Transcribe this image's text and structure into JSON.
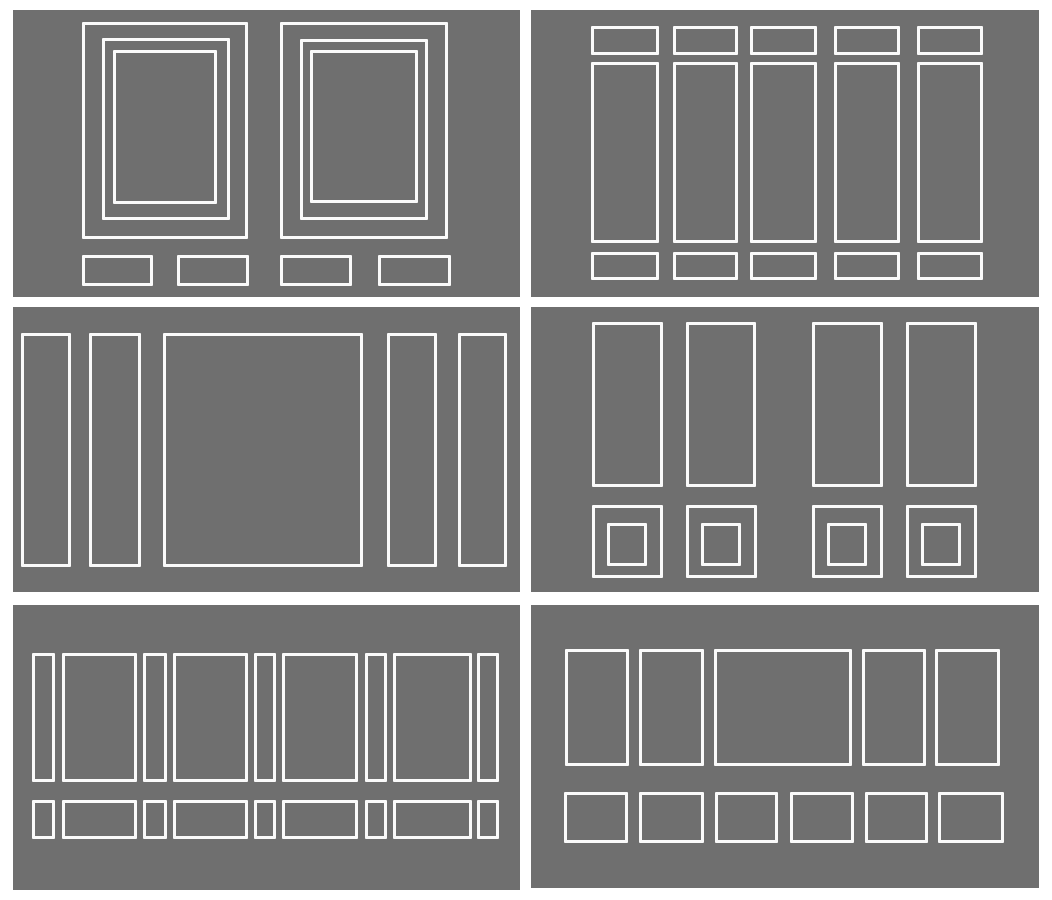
{
  "canvas": {
    "width": 1052,
    "height": 900,
    "background_color": "#ffffff"
  },
  "style": {
    "panel_background": "#6f6f6f",
    "stroke_color": "#fafafa",
    "stroke_width_px": 3
  },
  "panels": [
    {
      "key": "top-left",
      "x": 13,
      "y": 10,
      "w": 507,
      "h": 287,
      "rects": [
        {
          "x": 69,
          "y": 12,
          "w": 166,
          "h": 217
        },
        {
          "x": 89,
          "y": 28,
          "w": 128,
          "h": 182
        },
        {
          "x": 100,
          "y": 40,
          "w": 104,
          "h": 154
        },
        {
          "x": 267,
          "y": 12,
          "w": 168,
          "h": 217
        },
        {
          "x": 287,
          "y": 29,
          "w": 128,
          "h": 181
        },
        {
          "x": 297,
          "y": 40,
          "w": 108,
          "h": 153
        },
        {
          "x": 69,
          "y": 245,
          "w": 71,
          "h": 31
        },
        {
          "x": 164,
          "y": 245,
          "w": 72,
          "h": 31
        },
        {
          "x": 267,
          "y": 245,
          "w": 72,
          "h": 31
        },
        {
          "x": 365,
          "y": 245,
          "w": 73,
          "h": 31
        }
      ]
    },
    {
      "key": "top-right",
      "x": 531,
      "y": 10,
      "w": 508,
      "h": 287,
      "rects": [
        {
          "x": 60,
          "y": 16,
          "w": 68,
          "h": 29
        },
        {
          "x": 142,
          "y": 16,
          "w": 65,
          "h": 29
        },
        {
          "x": 219,
          "y": 16,
          "w": 67,
          "h": 29
        },
        {
          "x": 303,
          "y": 16,
          "w": 66,
          "h": 29
        },
        {
          "x": 386,
          "y": 16,
          "w": 66,
          "h": 29
        },
        {
          "x": 60,
          "y": 52,
          "w": 68,
          "h": 181
        },
        {
          "x": 142,
          "y": 52,
          "w": 65,
          "h": 181
        },
        {
          "x": 219,
          "y": 52,
          "w": 67,
          "h": 181
        },
        {
          "x": 303,
          "y": 52,
          "w": 66,
          "h": 181
        },
        {
          "x": 386,
          "y": 52,
          "w": 66,
          "h": 181
        },
        {
          "x": 60,
          "y": 242,
          "w": 68,
          "h": 28
        },
        {
          "x": 142,
          "y": 242,
          "w": 65,
          "h": 28
        },
        {
          "x": 219,
          "y": 242,
          "w": 67,
          "h": 28
        },
        {
          "x": 303,
          "y": 242,
          "w": 66,
          "h": 28
        },
        {
          "x": 386,
          "y": 242,
          "w": 66,
          "h": 28
        }
      ]
    },
    {
      "key": "middle-left",
      "x": 13,
      "y": 307,
      "w": 507,
      "h": 285,
      "rects": [
        {
          "x": 8,
          "y": 26,
          "w": 50,
          "h": 234
        },
        {
          "x": 76,
          "y": 26,
          "w": 52,
          "h": 234
        },
        {
          "x": 150,
          "y": 26,
          "w": 200,
          "h": 234
        },
        {
          "x": 374,
          "y": 26,
          "w": 50,
          "h": 234
        },
        {
          "x": 445,
          "y": 26,
          "w": 49,
          "h": 234
        }
      ]
    },
    {
      "key": "middle-right",
      "x": 531,
      "y": 307,
      "w": 508,
      "h": 285,
      "rects": [
        {
          "x": 61,
          "y": 15,
          "w": 71,
          "h": 165
        },
        {
          "x": 155,
          "y": 15,
          "w": 70,
          "h": 165
        },
        {
          "x": 281,
          "y": 15,
          "w": 71,
          "h": 165
        },
        {
          "x": 375,
          "y": 15,
          "w": 71,
          "h": 165
        },
        {
          "x": 61,
          "y": 198,
          "w": 71,
          "h": 73
        },
        {
          "x": 155,
          "y": 198,
          "w": 71,
          "h": 73
        },
        {
          "x": 281,
          "y": 198,
          "w": 71,
          "h": 73
        },
        {
          "x": 375,
          "y": 198,
          "w": 71,
          "h": 73
        },
        {
          "x": 76,
          "y": 216,
          "w": 40,
          "h": 43
        },
        {
          "x": 170,
          "y": 216,
          "w": 40,
          "h": 43
        },
        {
          "x": 296,
          "y": 216,
          "w": 40,
          "h": 43
        },
        {
          "x": 390,
          "y": 216,
          "w": 40,
          "h": 43
        }
      ]
    },
    {
      "key": "bottom-left",
      "x": 13,
      "y": 605,
      "w": 507,
      "h": 285,
      "rects": [
        {
          "x": 19,
          "y": 48,
          "w": 23,
          "h": 129
        },
        {
          "x": 49,
          "y": 48,
          "w": 75,
          "h": 129
        },
        {
          "x": 130,
          "y": 48,
          "w": 24,
          "h": 129
        },
        {
          "x": 160,
          "y": 48,
          "w": 75,
          "h": 129
        },
        {
          "x": 241,
          "y": 48,
          "w": 22,
          "h": 129
        },
        {
          "x": 269,
          "y": 48,
          "w": 76,
          "h": 129
        },
        {
          "x": 352,
          "y": 48,
          "w": 22,
          "h": 129
        },
        {
          "x": 380,
          "y": 48,
          "w": 79,
          "h": 129
        },
        {
          "x": 464,
          "y": 48,
          "w": 22,
          "h": 129
        },
        {
          "x": 19,
          "y": 195,
          "w": 23,
          "h": 39
        },
        {
          "x": 49,
          "y": 195,
          "w": 75,
          "h": 39
        },
        {
          "x": 130,
          "y": 195,
          "w": 24,
          "h": 39
        },
        {
          "x": 160,
          "y": 195,
          "w": 75,
          "h": 39
        },
        {
          "x": 241,
          "y": 195,
          "w": 22,
          "h": 39
        },
        {
          "x": 269,
          "y": 195,
          "w": 76,
          "h": 39
        },
        {
          "x": 352,
          "y": 195,
          "w": 22,
          "h": 39
        },
        {
          "x": 380,
          "y": 195,
          "w": 79,
          "h": 39
        },
        {
          "x": 464,
          "y": 195,
          "w": 22,
          "h": 39
        }
      ]
    },
    {
      "key": "bottom-right",
      "x": 531,
      "y": 605,
      "w": 508,
      "h": 283,
      "rects": [
        {
          "x": 34,
          "y": 44,
          "w": 64,
          "h": 117
        },
        {
          "x": 108,
          "y": 44,
          "w": 65,
          "h": 117
        },
        {
          "x": 183,
          "y": 44,
          "w": 138,
          "h": 117
        },
        {
          "x": 331,
          "y": 44,
          "w": 64,
          "h": 117
        },
        {
          "x": 404,
          "y": 44,
          "w": 65,
          "h": 117
        },
        {
          "x": 33,
          "y": 187,
          "w": 64,
          "h": 51
        },
        {
          "x": 108,
          "y": 187,
          "w": 65,
          "h": 51
        },
        {
          "x": 184,
          "y": 187,
          "w": 63,
          "h": 51
        },
        {
          "x": 259,
          "y": 187,
          "w": 64,
          "h": 51
        },
        {
          "x": 334,
          "y": 187,
          "w": 63,
          "h": 51
        },
        {
          "x": 407,
          "y": 187,
          "w": 66,
          "h": 51
        }
      ]
    }
  ]
}
